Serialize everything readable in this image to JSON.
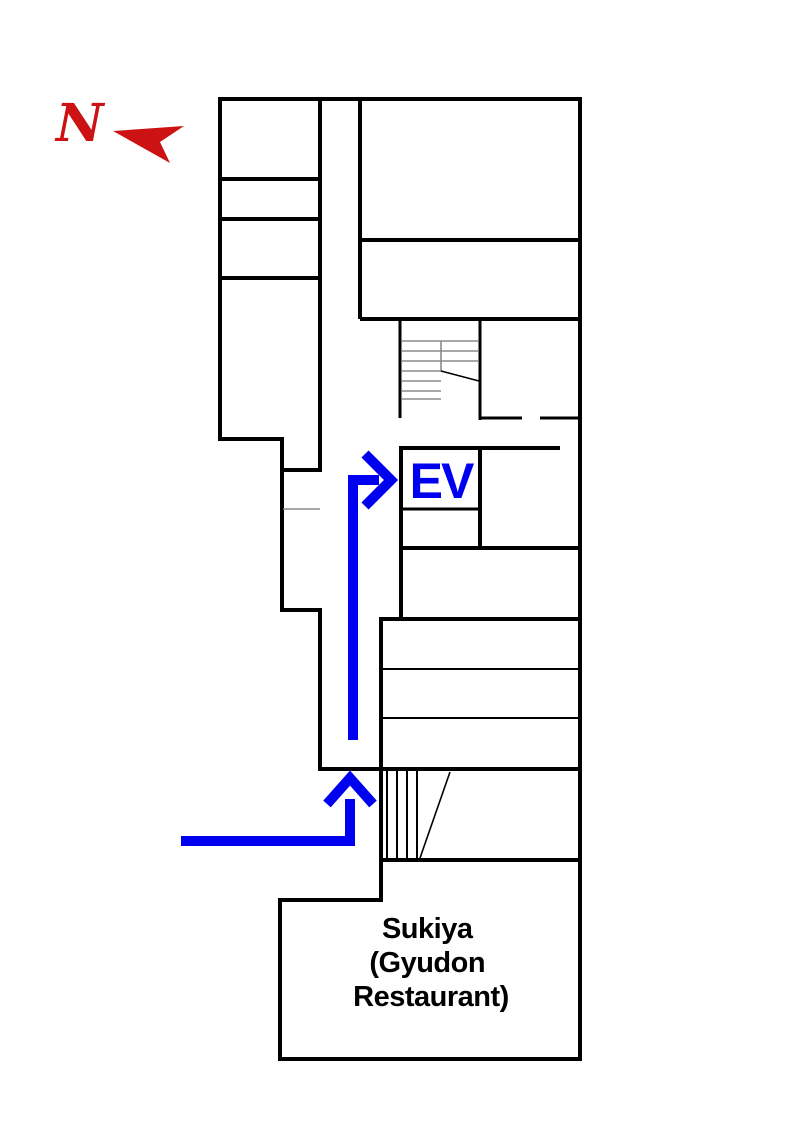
{
  "compass": {
    "letter": "N",
    "arrow_icon": "north-pointer-left"
  },
  "labels": {
    "elevator": "EV",
    "restaurant": [
      "Sukiya",
      "(Gyudon",
      "Restaurant)"
    ]
  },
  "colors": {
    "wall": "#000000",
    "stair_hatch": "#000000",
    "stair_tread": "#8a8a8a",
    "door_line": "#8a8a8a",
    "route": "#0000f0",
    "north": "#cc1212",
    "text": "#000000",
    "background": "#ffffff"
  }
}
